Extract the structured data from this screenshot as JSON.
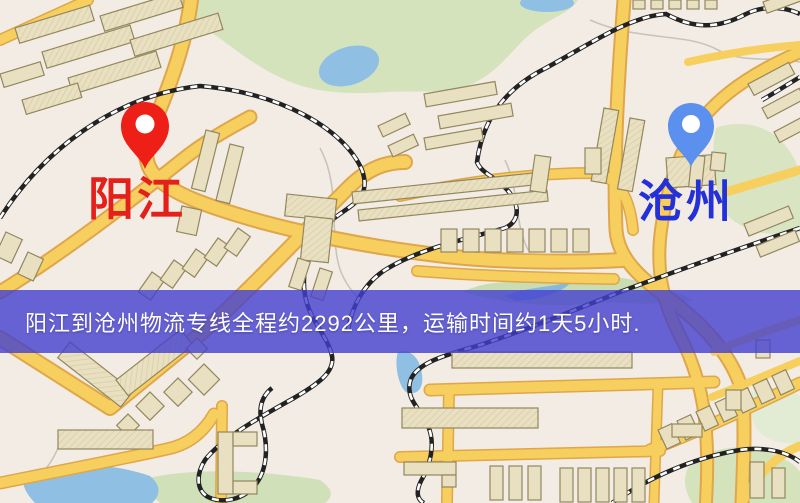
{
  "map": {
    "origin": {
      "label": "阳江",
      "marker_color": "#ee1f16",
      "label_color": "#e3201b"
    },
    "destination": {
      "label": "沧州",
      "marker_color": "#5b90ee",
      "label_color": "#2531d8"
    },
    "colors": {
      "background": "#f3ece4",
      "road_fill": "#f6cf5e",
      "road_casing": "#dfa64b",
      "park": "#d5e3bd",
      "water": "#8fc0e4",
      "building": "#e9e0c1",
      "building_outline": "#93875f",
      "railway": "#222222"
    }
  },
  "banner": {
    "text": "阳江到沧州物流专线全程约2292公里，运输时间约1天5小时.",
    "distance_km": "2292",
    "duration": "1天5小时",
    "background_color": "#4340ce",
    "text_color": "#ffffff"
  }
}
